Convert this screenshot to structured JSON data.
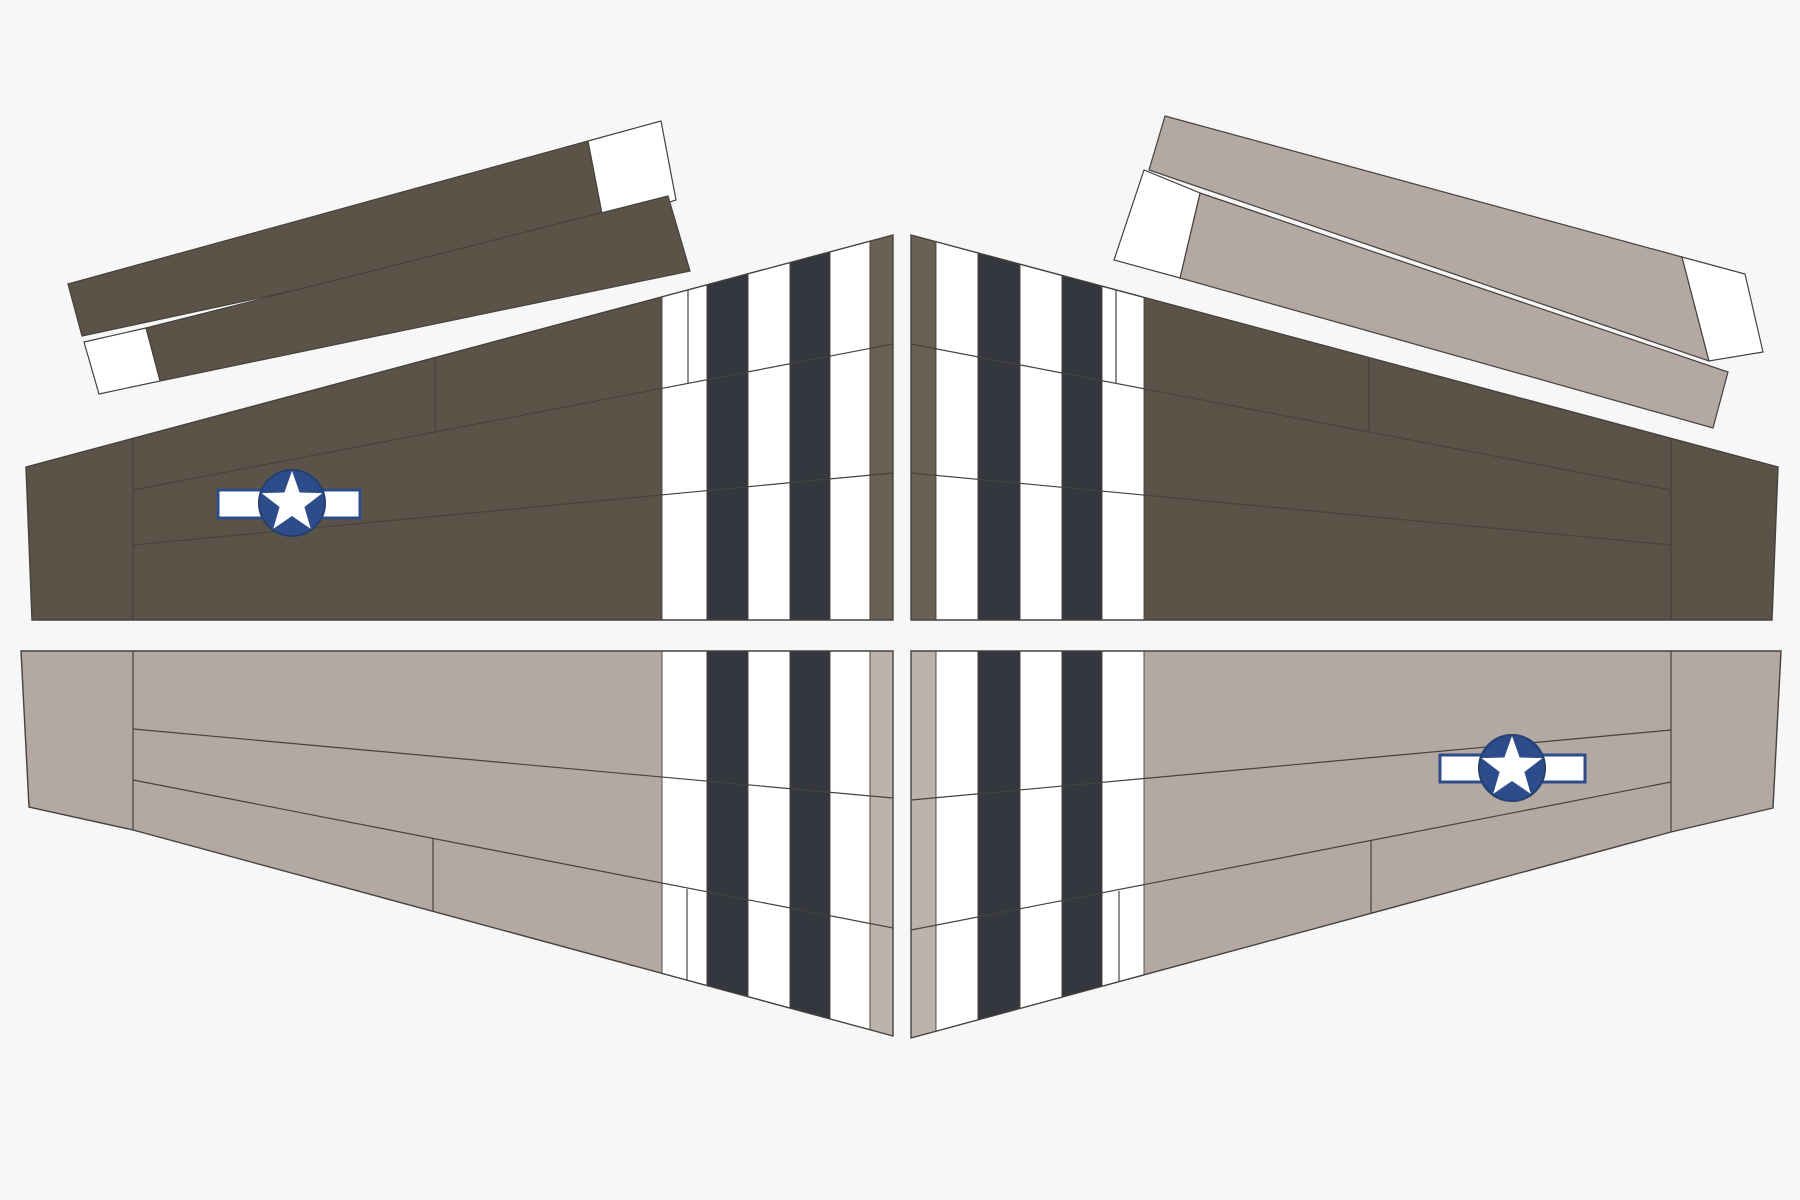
{
  "canvas": {
    "width": 1800,
    "height": 1200,
    "background": "#f7f7f8"
  },
  "palette": {
    "olive": "#5c5348",
    "olive_light": "#6a6054",
    "gray": "#b3a8a2",
    "gray_light": "#bdb2ac",
    "black": "#34373d",
    "white": "#ffffff",
    "outline": "#45413c",
    "line": "#46423d",
    "navy": "#2e4c8a",
    "navy_dark": "#24406f"
  },
  "stripe_band": {
    "y1": 150,
    "y2": 1100
  },
  "parts": [
    {
      "id": "wing-top-left",
      "type": "wing",
      "fill": "olive",
      "outline": [
        [
          26,
          467
        ],
        [
          893,
          235
        ],
        [
          893,
          620
        ],
        [
          32,
          620
        ]
      ],
      "stripes": [
        {
          "x1": 662,
          "x2": 707,
          "color": "white"
        },
        {
          "x1": 707,
          "x2": 748,
          "color": "black"
        },
        {
          "x1": 748,
          "x2": 790,
          "color": "white"
        },
        {
          "x1": 790,
          "x2": 830,
          "color": "black"
        },
        {
          "x1": 830,
          "x2": 870,
          "color": "white"
        },
        {
          "x1": 870,
          "x2": 893,
          "color": "olive_light"
        }
      ],
      "lines": [
        [
          133,
          438,
          133,
          620
        ],
        [
          133,
          490,
          893,
          344
        ],
        [
          133,
          545,
          893,
          473
        ],
        [
          435,
          358,
          435,
          432
        ],
        [
          688,
          290,
          688,
          383
        ]
      ],
      "insignia": {
        "cx": 292,
        "cy": 503,
        "r": 33,
        "star_r": 32,
        "star_ri": 13,
        "bar": [
          218,
          490,
          142,
          28
        ]
      }
    },
    {
      "id": "wing-top-right",
      "type": "wing",
      "fill": "olive",
      "outline": [
        [
          911,
          235
        ],
        [
          1778,
          467
        ],
        [
          1772,
          620
        ],
        [
          911,
          620
        ]
      ],
      "stripes": [
        {
          "x1": 911,
          "x2": 936,
          "color": "olive_light"
        },
        {
          "x1": 936,
          "x2": 978,
          "color": "white"
        },
        {
          "x1": 978,
          "x2": 1020,
          "color": "black"
        },
        {
          "x1": 1020,
          "x2": 1062,
          "color": "white"
        },
        {
          "x1": 1062,
          "x2": 1102,
          "color": "black"
        },
        {
          "x1": 1102,
          "x2": 1144,
          "color": "white"
        }
      ],
      "lines": [
        [
          1671,
          438,
          1671,
          620
        ],
        [
          911,
          344,
          1671,
          490
        ],
        [
          911,
          473,
          1671,
          545
        ],
        [
          1369,
          358,
          1369,
          432
        ],
        [
          1116,
          290,
          1116,
          383
        ]
      ],
      "insignia": null
    },
    {
      "id": "wing-bottom-left",
      "type": "wing",
      "fill": "gray",
      "outline": [
        [
          21,
          651
        ],
        [
          893,
          651
        ],
        [
          893,
          1036
        ],
        [
          133,
          830
        ],
        [
          29,
          807
        ]
      ],
      "stripes": [
        {
          "x1": 662,
          "x2": 707,
          "color": "white"
        },
        {
          "x1": 707,
          "x2": 748,
          "color": "black"
        },
        {
          "x1": 748,
          "x2": 790,
          "color": "white"
        },
        {
          "x1": 790,
          "x2": 830,
          "color": "black"
        },
        {
          "x1": 830,
          "x2": 870,
          "color": "white"
        },
        {
          "x1": 870,
          "x2": 893,
          "color": "gray_light"
        }
      ],
      "lines": [
        [
          133,
          651,
          133,
          830
        ],
        [
          133,
          729,
          893,
          798
        ],
        [
          133,
          780,
          893,
          928
        ],
        [
          433,
          838,
          433,
          912
        ],
        [
          687,
          889,
          687,
          980
        ]
      ],
      "insignia": null
    },
    {
      "id": "wing-bottom-right",
      "type": "wing",
      "fill": "gray",
      "outline": [
        [
          911,
          651
        ],
        [
          1781,
          651
        ],
        [
          1773,
          808
        ],
        [
          1671,
          832
        ],
        [
          911,
          1038
        ]
      ],
      "stripes": [
        {
          "x1": 911,
          "x2": 936,
          "color": "gray_light"
        },
        {
          "x1": 936,
          "x2": 978,
          "color": "white"
        },
        {
          "x1": 978,
          "x2": 1020,
          "color": "black"
        },
        {
          "x1": 1020,
          "x2": 1062,
          "color": "white"
        },
        {
          "x1": 1062,
          "x2": 1102,
          "color": "black"
        },
        {
          "x1": 1102,
          "x2": 1144,
          "color": "white"
        }
      ],
      "lines": [
        [
          1671,
          651,
          1671,
          832
        ],
        [
          911,
          800,
          1671,
          730
        ],
        [
          911,
          930,
          1671,
          782
        ],
        [
          1371,
          841,
          1371,
          914
        ],
        [
          1119,
          891,
          1119,
          982
        ]
      ],
      "insignia": {
        "cx": 1512,
        "cy": 768,
        "r": 33,
        "star_r": 32,
        "star_ri": 13,
        "bar": [
          1440,
          755,
          145,
          27
        ]
      }
    },
    {
      "id": "stabilizer-top-left",
      "type": "stabilizer",
      "polys": [
        {
          "points": [
            [
              68,
              284
            ],
            [
              588,
              141
            ],
            [
              604,
              224
            ],
            [
              82,
              336
            ]
          ],
          "color": "olive",
          "name": "strip-upper"
        },
        {
          "points": [
            [
              588,
              141
            ],
            [
              661,
              121
            ],
            [
              676,
              200
            ],
            [
              604,
              224
            ]
          ],
          "color": "white",
          "name": "strip-upper-white-tip"
        },
        {
          "points": [
            [
              146,
              328
            ],
            [
              668,
              196
            ],
            [
              690,
              271
            ],
            [
              160,
              381
            ]
          ],
          "color": "olive",
          "name": "strip-lower"
        },
        {
          "points": [
            [
              84,
              342
            ],
            [
              146,
              328
            ],
            [
              160,
              381
            ],
            [
              99,
              394
            ]
          ],
          "color": "white",
          "name": "strip-lower-white-tip"
        }
      ]
    },
    {
      "id": "stabilizer-top-right",
      "type": "stabilizer",
      "polys": [
        {
          "points": [
            [
              1165,
              116
            ],
            [
              1682,
              257
            ],
            [
              1709,
              361
            ],
            [
              1149,
              170
            ]
          ],
          "color": "gray",
          "name": "strip-upper"
        },
        {
          "points": [
            [
              1682,
              257
            ],
            [
              1745,
              274
            ],
            [
              1763,
              352
            ],
            [
              1709,
              361
            ]
          ],
          "color": "white",
          "name": "strip-upper-white-tip"
        },
        {
          "points": [
            [
              1200,
              193
            ],
            [
              1728,
              372
            ],
            [
              1713,
              428
            ],
            [
              1180,
              278
            ]
          ],
          "color": "gray",
          "name": "strip-lower"
        },
        {
          "points": [
            [
              1144,
              170
            ],
            [
              1200,
              193
            ],
            [
              1180,
              278
            ],
            [
              1114,
              260
            ]
          ],
          "color": "white",
          "name": "strip-lower-white-tip"
        }
      ]
    }
  ]
}
